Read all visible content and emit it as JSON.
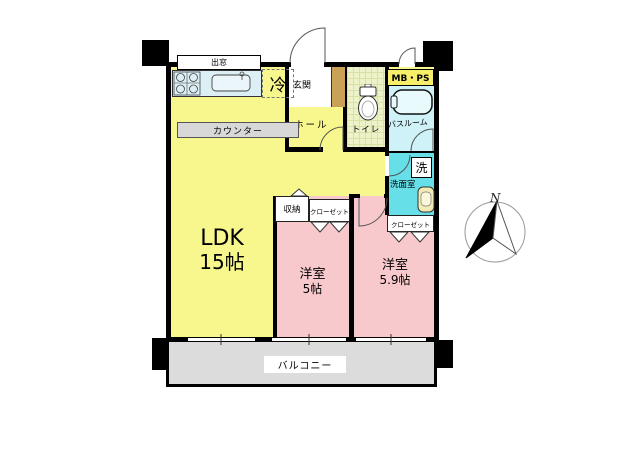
{
  "rooms": {
    "ldk": {
      "name": "LDK",
      "size": "15帖"
    },
    "bedroom1": {
      "name": "洋室",
      "size": "5帖"
    },
    "bedroom2": {
      "name": "洋室",
      "size": "5.9帖"
    },
    "entrance": {
      "name": "玄関"
    },
    "hall": {
      "name": "ホール"
    },
    "toilet": {
      "name": "トイレ"
    },
    "bathroom": {
      "name": "バスルーム"
    },
    "washroom": {
      "name": "洗面室"
    },
    "balcony": {
      "name": "バルコニー"
    }
  },
  "fixtures": {
    "bay_window": "出窓",
    "refrigerator": "冷",
    "counter": "カウンター",
    "washer": "洗",
    "meter_box": "MB・PS",
    "storage": "収納",
    "closet_bedroom1": "クローゼット",
    "closet_bedroom2": "クローゼット"
  },
  "compass": {
    "north": "N"
  },
  "colors": {
    "ldk": "#F8F78E",
    "bedroom": "#F7C9CC",
    "washroom": "#67DFE8",
    "bathroom": "#CEF2F7",
    "toilet": "#EDF2C9",
    "toilet_grid": "#D8E2A6",
    "balcony": "#DCDCDC",
    "counter_bar": "#D8D8D8",
    "meter_box": "#F7EF6A",
    "kitchen": "#DCEFF4",
    "shoe_cabinet": "#C9A257",
    "wall": "#000000"
  }
}
